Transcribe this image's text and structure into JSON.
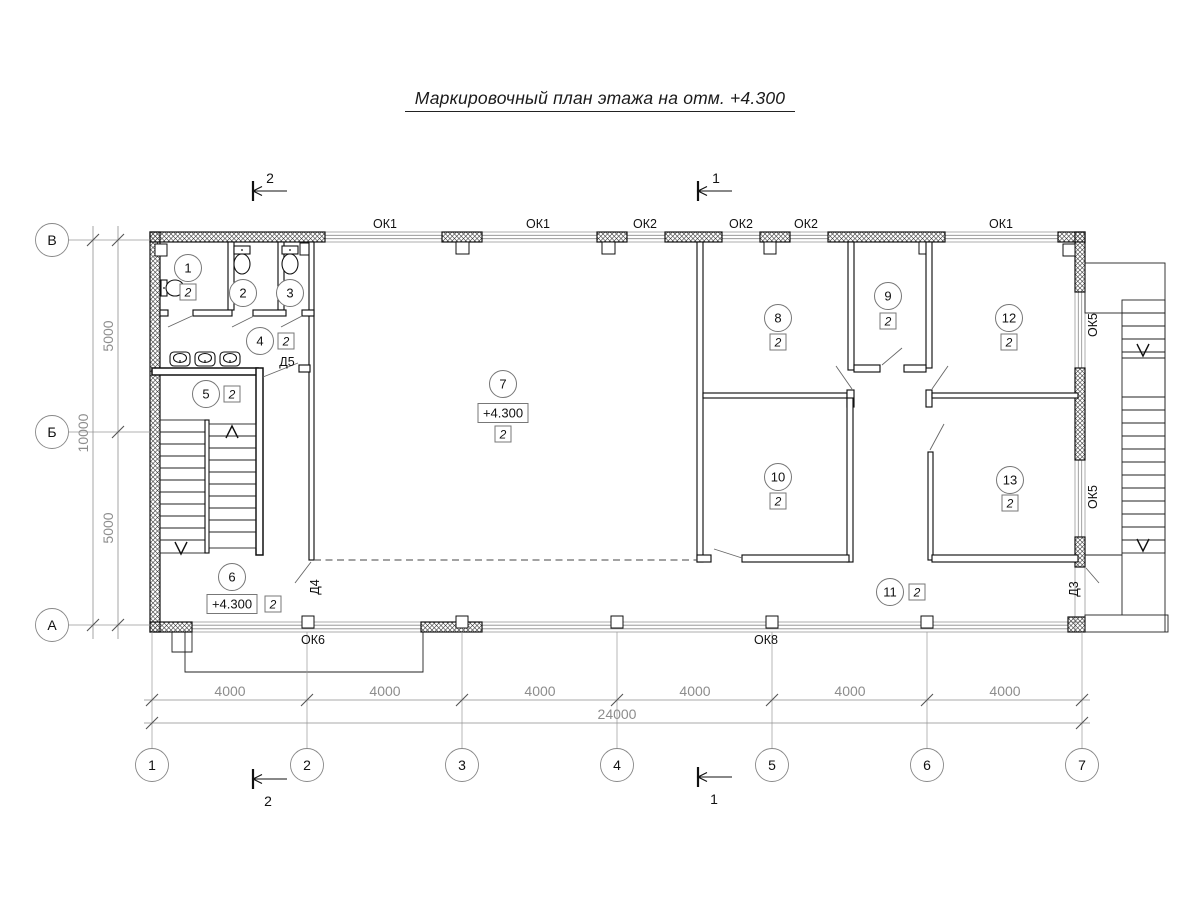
{
  "title": "Маркировочный план этажа на отм. +4.300",
  "plan": {
    "finish_value": "2",
    "room_markers": [
      {
        "num": "1",
        "cx": 188,
        "cy": 268,
        "finish": {
          "x": 188,
          "y": 292
        }
      },
      {
        "num": "2",
        "cx": 243,
        "cy": 293
      },
      {
        "num": "3",
        "cx": 290,
        "cy": 293
      },
      {
        "num": "4",
        "cx": 260,
        "cy": 341,
        "finish": {
          "x": 286,
          "y": 341
        }
      },
      {
        "num": "5",
        "cx": 206,
        "cy": 394,
        "finish": {
          "x": 232,
          "y": 394
        }
      },
      {
        "num": "6",
        "cx": 232,
        "cy": 577,
        "elevation": {
          "x": 232,
          "y": 604,
          "text": "+4.300"
        },
        "finish": {
          "x": 273,
          "y": 604
        }
      },
      {
        "num": "7",
        "cx": 503,
        "cy": 384,
        "elevation": {
          "x": 503,
          "y": 413,
          "text": "+4.300"
        },
        "finish": {
          "x": 503,
          "y": 434
        }
      },
      {
        "num": "8",
        "cx": 778,
        "cy": 318,
        "finish": {
          "x": 778,
          "y": 342
        }
      },
      {
        "num": "9",
        "cx": 888,
        "cy": 296,
        "finish": {
          "x": 888,
          "y": 321
        }
      },
      {
        "num": "10",
        "cx": 778,
        "cy": 477,
        "finish": {
          "x": 778,
          "y": 501
        }
      },
      {
        "num": "11",
        "cx": 890,
        "cy": 592,
        "finish": {
          "x": 917,
          "y": 592
        }
      },
      {
        "num": "12",
        "cx": 1009,
        "cy": 318,
        "finish": {
          "x": 1009,
          "y": 342
        }
      },
      {
        "num": "13",
        "cx": 1010,
        "cy": 480,
        "finish": {
          "x": 1010,
          "y": 503
        }
      }
    ],
    "window_labels": [
      {
        "text": "ОК1",
        "x": 385,
        "y": 228
      },
      {
        "text": "ОК1",
        "x": 538,
        "y": 228
      },
      {
        "text": "ОК2",
        "x": 645,
        "y": 228
      },
      {
        "text": "ОК2",
        "x": 741,
        "y": 228
      },
      {
        "text": "ОК2",
        "x": 806,
        "y": 228
      },
      {
        "text": "ОК1",
        "x": 1001,
        "y": 228
      },
      {
        "text": "ОК5",
        "x": 1097,
        "y": 325,
        "rotate": true
      },
      {
        "text": "ОК5",
        "x": 1097,
        "y": 497,
        "rotate": true
      },
      {
        "text": "ОК6",
        "x": 313,
        "y": 644
      },
      {
        "text": "ОК8",
        "x": 766,
        "y": 644
      }
    ],
    "door_labels": [
      {
        "text": "Д5",
        "x": 287,
        "y": 366
      },
      {
        "text": "Д4",
        "x": 319,
        "y": 587,
        "rotate": true
      },
      {
        "text": "Д3",
        "x": 1078,
        "y": 589,
        "rotate": true
      }
    ],
    "axis_letters": [
      {
        "label": "В",
        "cx": 52,
        "cy": 240
      },
      {
        "label": "Б",
        "cx": 52,
        "cy": 432
      },
      {
        "label": "А",
        "cx": 52,
        "cy": 625
      }
    ],
    "axis_numbers": [
      {
        "label": "1",
        "cx": 152,
        "cy": 765
      },
      {
        "label": "2",
        "cx": 307,
        "cy": 765
      },
      {
        "label": "3",
        "cx": 462,
        "cy": 765
      },
      {
        "label": "4",
        "cx": 617,
        "cy": 765
      },
      {
        "label": "5",
        "cx": 772,
        "cy": 765
      },
      {
        "label": "6",
        "cx": 927,
        "cy": 765
      },
      {
        "label": "7",
        "cx": 1082,
        "cy": 765
      }
    ],
    "dimensions": {
      "left_inner": [
        {
          "text": "5000",
          "x": 113,
          "y": 336
        },
        {
          "text": "5000",
          "x": 113,
          "y": 528
        }
      ],
      "left_outer": [
        {
          "text": "10000",
          "x": 88,
          "y": 433
        }
      ],
      "bottom": [
        {
          "text": "4000",
          "x": 230,
          "y": 696
        },
        {
          "text": "4000",
          "x": 385,
          "y": 696
        },
        {
          "text": "4000",
          "x": 540,
          "y": 696
        },
        {
          "text": "4000",
          "x": 695,
          "y": 696
        },
        {
          "text": "4000",
          "x": 850,
          "y": 696
        },
        {
          "text": "4000",
          "x": 1005,
          "y": 696
        }
      ],
      "total": {
        "text": "24000",
        "x": 617,
        "y": 719
      }
    },
    "section_marks": [
      {
        "label": "2",
        "bar_x": 253,
        "y": 191,
        "len": 34,
        "label_x": 270,
        "label_y": 183
      },
      {
        "label": "1",
        "bar_x": 698,
        "y": 191,
        "len": 34,
        "label_x": 716,
        "label_y": 183
      },
      {
        "label": "2",
        "bar_x": 253,
        "y": 779,
        "len": 34,
        "label_x": 268,
        "label_y": 806
      },
      {
        "label": "1",
        "bar_x": 698,
        "y": 777,
        "len": 34,
        "label_x": 714,
        "label_y": 804
      }
    ]
  }
}
